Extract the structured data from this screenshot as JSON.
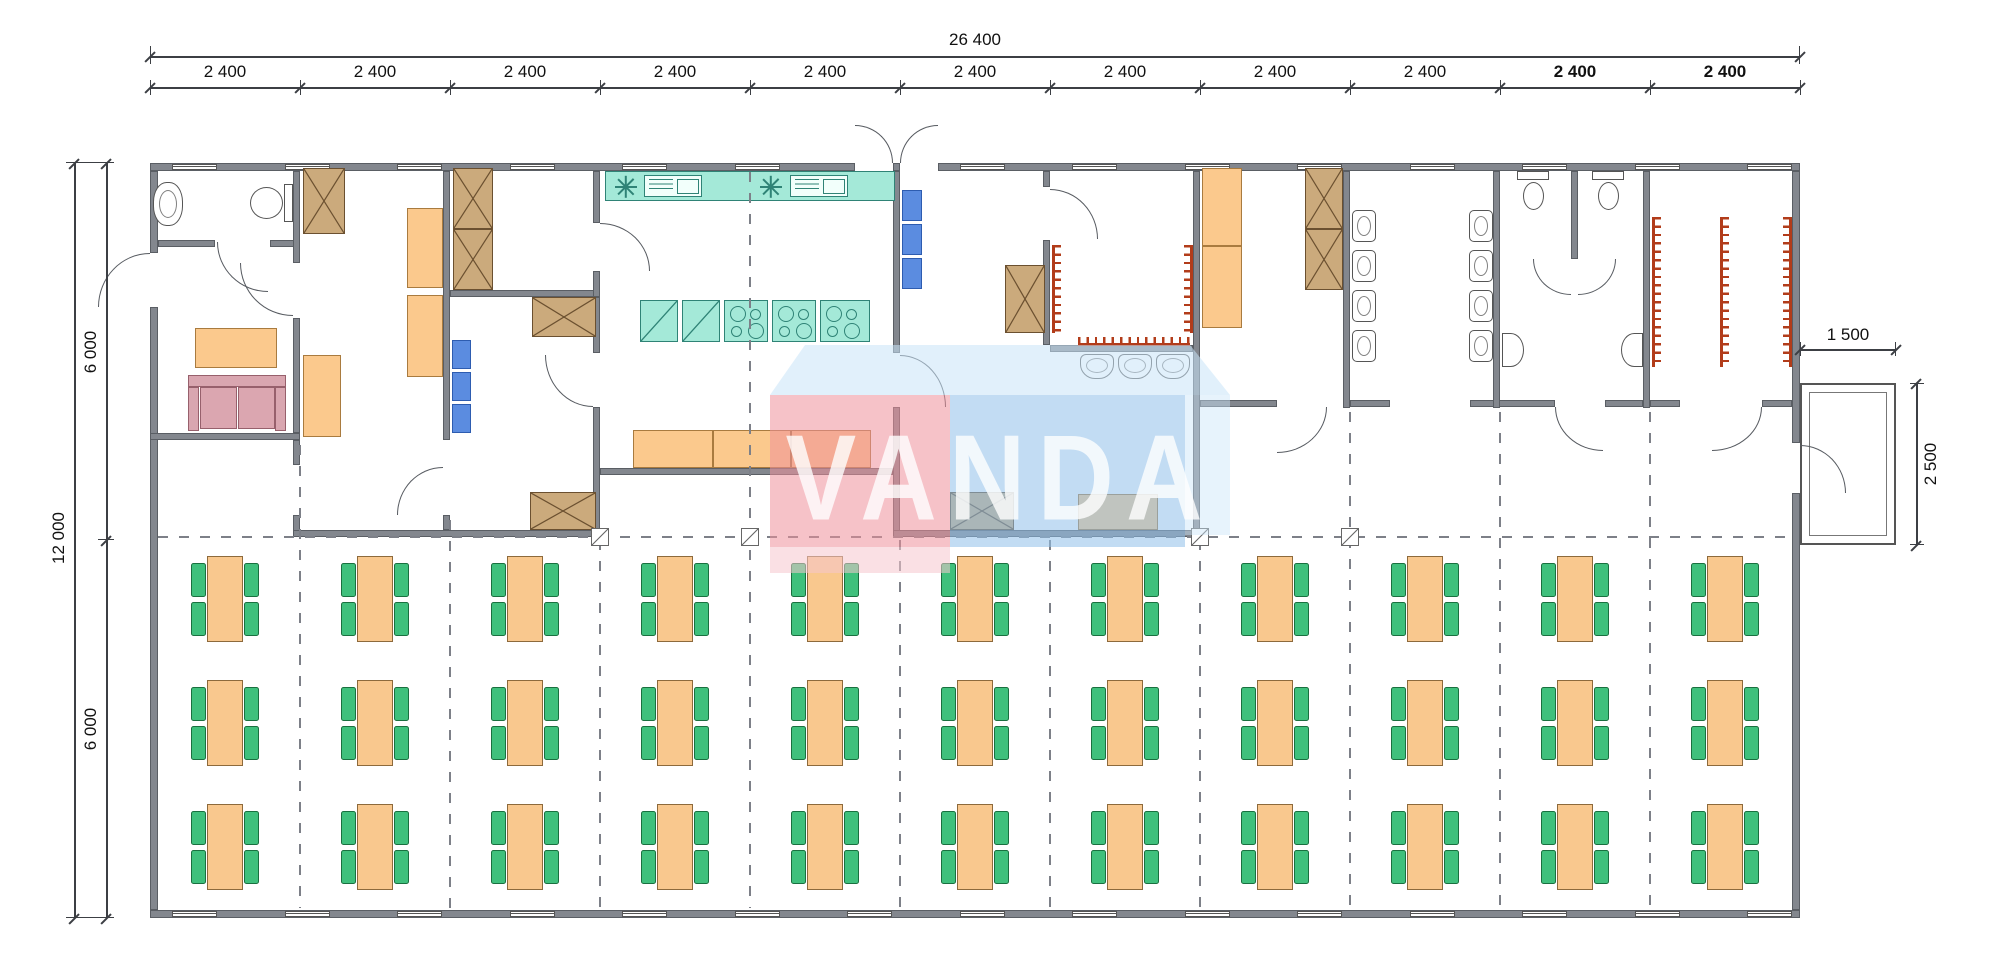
{
  "watermark": {
    "text": "VANDA"
  },
  "dimensions": {
    "top_total": "26 400",
    "top_segments": [
      {
        "label": "2 400",
        "bold": false
      },
      {
        "label": "2 400",
        "bold": false
      },
      {
        "label": "2 400",
        "bold": false
      },
      {
        "label": "2 400",
        "bold": false
      },
      {
        "label": "2 400",
        "bold": false
      },
      {
        "label": "2 400",
        "bold": false
      },
      {
        "label": "2 400",
        "bold": false
      },
      {
        "label": "2 400",
        "bold": false
      },
      {
        "label": "2 400",
        "bold": false
      },
      {
        "label": "2 400",
        "bold": true
      },
      {
        "label": "2 400",
        "bold": true
      }
    ],
    "left_total": "12 000",
    "left_upper_half": "6 000",
    "left_lower_half": "6 000",
    "porch_width": "1 500",
    "porch_depth": "2 500"
  },
  "dining_hall": {
    "table_columns": 11,
    "table_rows": 3,
    "chairs_per_table": 4
  },
  "fixtures": {
    "urinals": 8,
    "wash_basins": 3,
    "toilets": 3,
    "sinks": 3,
    "coat_racks": 6,
    "kitchen_stoves": 3,
    "kitchen_fridges": 2,
    "kitchen_sink_units": 2,
    "kitchen_lamps": 2
  },
  "colors": {
    "wall": "#83878e",
    "wall_edge": "#5a5e64",
    "teal_fill": "#a4e9d8",
    "teal_edge": "#2f8376",
    "orange_fill": "#fbc98d",
    "orange_edge": "#a97b3f",
    "brown_fill": "#cbaa7c",
    "brown_edge": "#6b5030",
    "blue_fill": "#5b8ce0",
    "chair_green": "#3fc07c",
    "table_orange": "#f9c88e",
    "sofa_pink": "#d9a6b0",
    "rack_red": "#b23c1a",
    "dash_gray": "#7d8088",
    "dim_text": "#111111",
    "watermark_pink": "#ef8f9b",
    "watermark_blue": "#8fc0ea",
    "watermark_band": "#c9e4f8",
    "watermark_text": "#ffffff"
  }
}
